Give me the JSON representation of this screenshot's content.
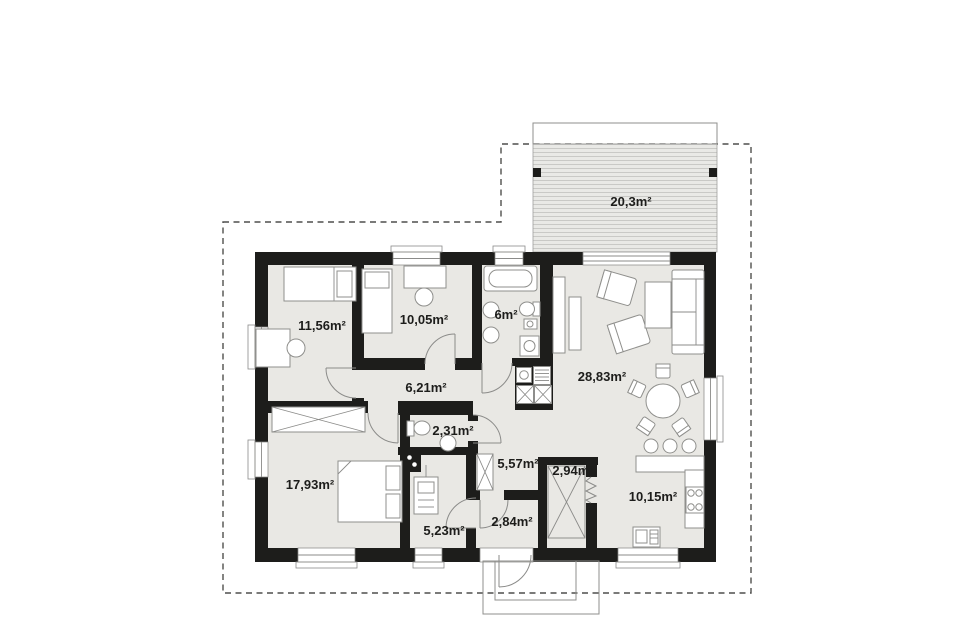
{
  "colors": {
    "background": "#ffffff",
    "wall": "#1d1d1b",
    "floor": "#e9e8e4",
    "outline": "#8f8f8c",
    "dashed": "#4f4f4d",
    "text": "#1d1d1b",
    "terrace_fill": "#e9e9e6",
    "terrace_stripe": "#c9c9c6"
  },
  "plan": {
    "rooms": [
      {
        "id": "terrace",
        "area_label": "20,3m²"
      },
      {
        "id": "bedroom-1",
        "area_label": "11,56m²"
      },
      {
        "id": "bedroom-2",
        "area_label": "10,05m²"
      },
      {
        "id": "bathroom",
        "area_label": "6m²"
      },
      {
        "id": "hall",
        "area_label": "6,21m²"
      },
      {
        "id": "living-room",
        "area_label": "28,83m²"
      },
      {
        "id": "wc",
        "area_label": "2,31m²"
      },
      {
        "id": "hall-2",
        "area_label": "5,57m²"
      },
      {
        "id": "pantry",
        "area_label": "2,94m²"
      },
      {
        "id": "bedroom-3",
        "area_label": "17,93m²"
      },
      {
        "id": "boiler-room",
        "area_label": "5,23m²"
      },
      {
        "id": "vestibule",
        "area_label": "2,84m²"
      },
      {
        "id": "kitchen",
        "area_label": "10,15m²"
      }
    ]
  }
}
